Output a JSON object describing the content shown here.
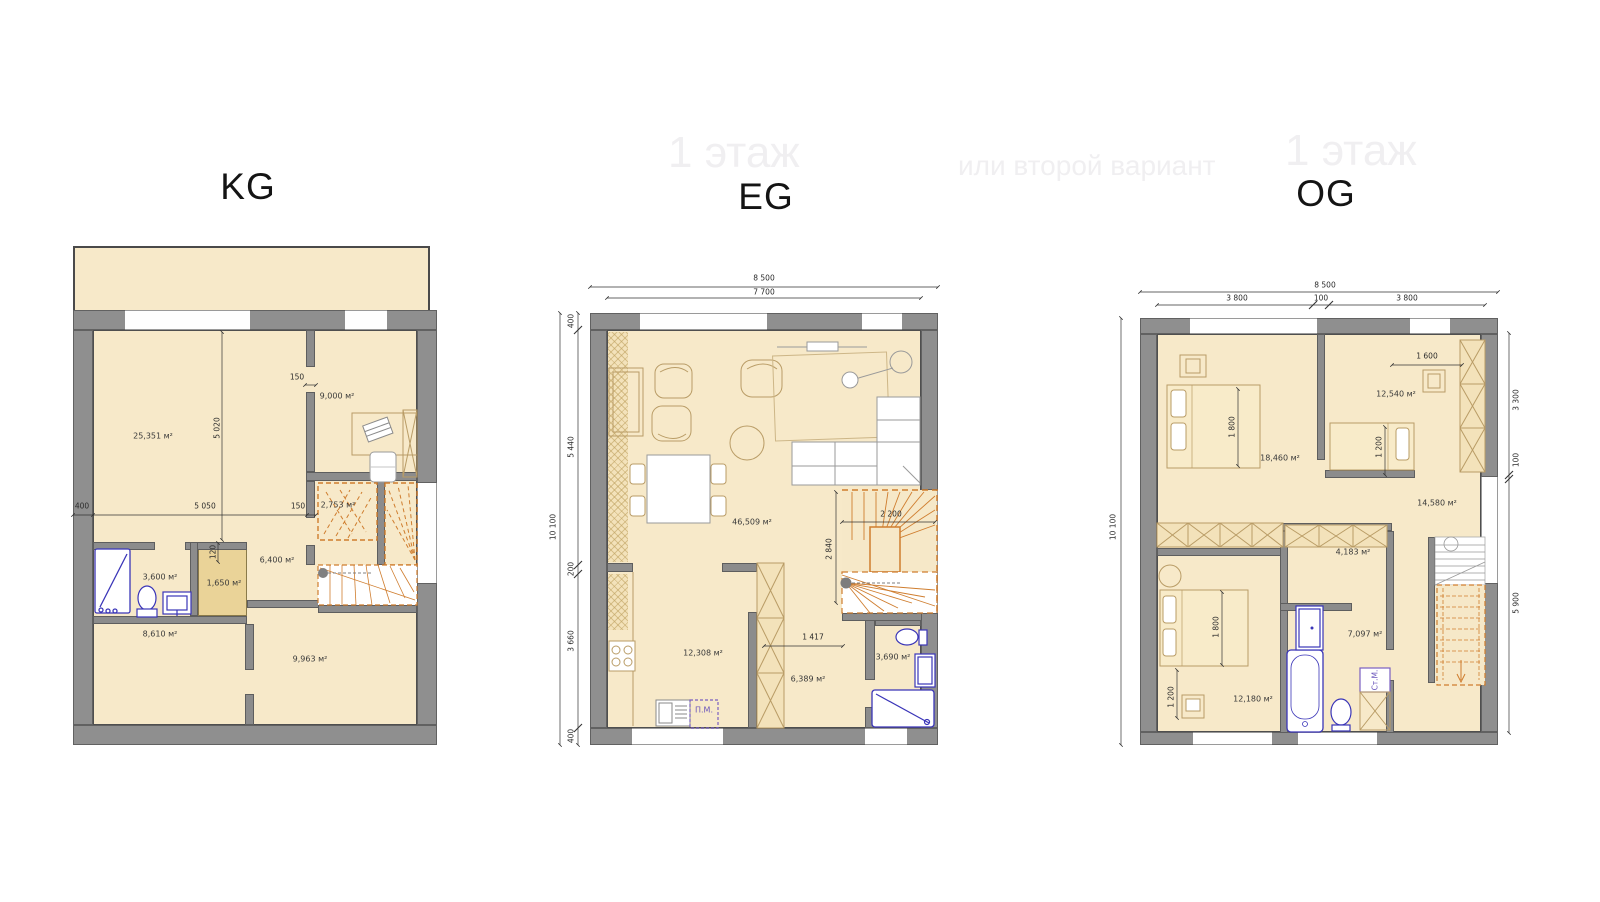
{
  "colors": {
    "wall": "#8f8f8f",
    "floor": "#f7e9c9",
    "floor_dark": "#ead398",
    "stair_orange": "#cf7d2e",
    "sanitary_blue": "#3a35b8",
    "appliance_purple": "#7a5fc0",
    "dim_text": "#2b2b2b",
    "watermark": "#f0eff1"
  },
  "watermarks": {
    "left": "1 этаж",
    "right_small": "или второй вариант",
    "right_large": "1 этаж"
  },
  "kg": {
    "title": "KG",
    "rooms": {
      "main": "25,351 м²",
      "office": "9,000 м²",
      "stair": "2,753 м²",
      "bath": "3,600 м²",
      "storage": "1,650 м²",
      "hall": "6,400 м²",
      "room_bl": "8,610 м²",
      "room_br": "9,963 м²"
    },
    "dims": {
      "w400": "400",
      "w5050": "5 050",
      "door150a": "150",
      "door150b": "150",
      "h5020": "5 020",
      "w120": "120"
    }
  },
  "eg": {
    "title": "EG",
    "rooms": {
      "living": "46,509 м²",
      "kitchen": "12,308 м²",
      "hall": "6,389 м²",
      "bath": "3,690 м²"
    },
    "appliance_pm": "П.М.",
    "dims": {
      "t8500": "8 500",
      "t7700": "7 700",
      "l10100": "10 100",
      "l400a": "400",
      "l5440": "5 440",
      "l200": "200",
      "l3660": "3 660",
      "l400b": "400",
      "s2200": "2 200",
      "s2840": "2 840",
      "h1417": "1 417"
    }
  },
  "og": {
    "title": "OG",
    "rooms": {
      "bed1": "18,460 м²",
      "bed2": "12,540 м²",
      "hall": "14,580 м²",
      "closet": "4,183 м²",
      "bath": "7,097 м²",
      "bed3": "12,180 м²"
    },
    "appliance_stm": "Ст.М.",
    "dims": {
      "t8500": "8 500",
      "t3800a": "3 800",
      "t100": "100",
      "t3800b": "3 800",
      "l10100": "10 100",
      "r3300": "3 300",
      "r100": "100",
      "r5900": "5 900",
      "b1600": "1 600",
      "b1200a": "1 200",
      "b1800a": "1 800",
      "b1800b": "1 800",
      "b1200b": "1 200"
    }
  }
}
